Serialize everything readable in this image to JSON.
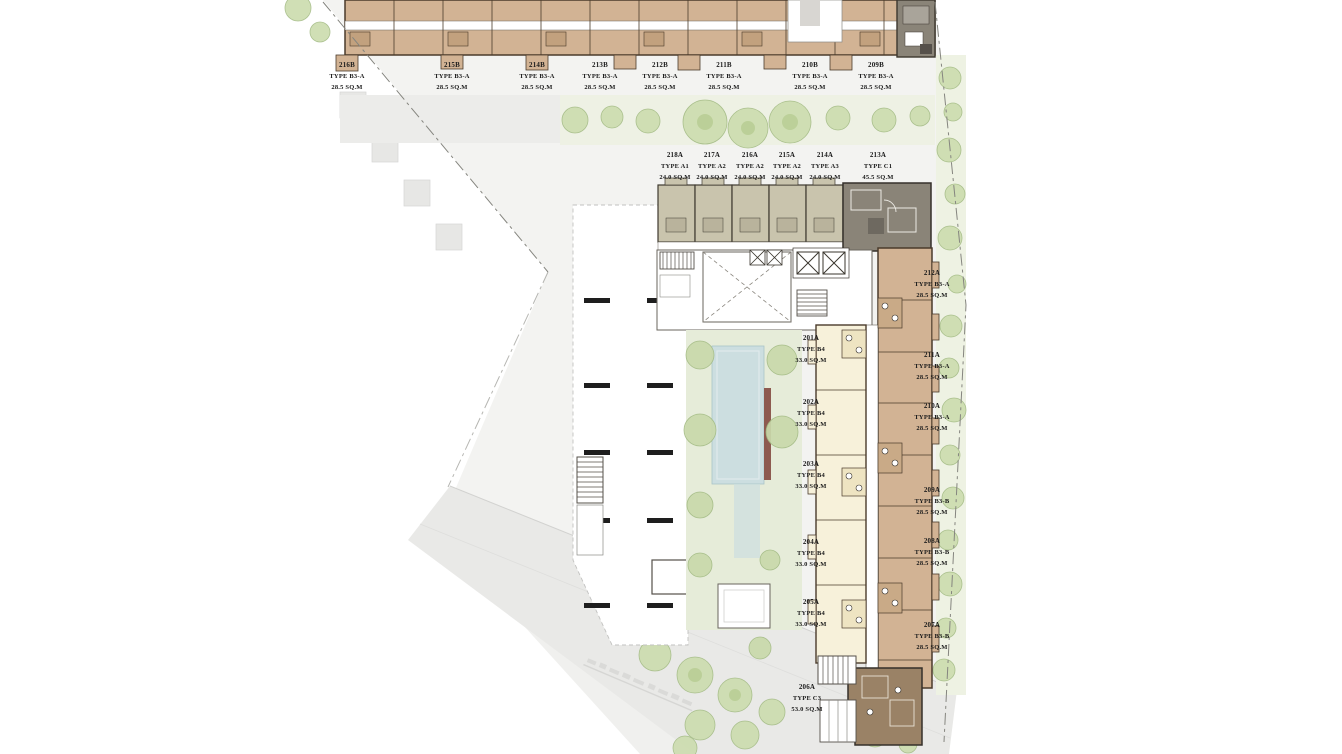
{
  "plan": {
    "name": "residential-floor-plan",
    "palette": {
      "unit_tan": "#d2b394",
      "unit_tan_dark": "#c2a17e",
      "unit_gray": "#8a8478",
      "unit_cream": "#f7f1da",
      "unit_brown": "#9a8266",
      "unit_sage": "#c9c4ad",
      "pool_blue": "#ccdee0",
      "deck_red": "#8d5a50",
      "tree_green": "#ccdcae",
      "parcel_gray": "#f3f3f1",
      "outline_brown": "#4a3b2b"
    }
  },
  "units": {
    "top_row": [
      {
        "id": "216B",
        "type": "TYPE B3-A",
        "area": "28.5 SQ.M"
      },
      {
        "id": "215B",
        "type": "TYPE B3-A",
        "area": "28.5 SQ.M"
      },
      {
        "id": "214B",
        "type": "TYPE B3-A",
        "area": "28.5 SQ.M"
      },
      {
        "id": "213B",
        "type": "TYPE B3-A",
        "area": "28.5 SQ.M"
      },
      {
        "id": "212B",
        "type": "TYPE B3-A",
        "area": "28.5 SQ.M"
      },
      {
        "id": "211B",
        "type": "TYPE B3-A",
        "area": "28.5 SQ.M"
      },
      {
        "id": "210B",
        "type": "TYPE B3-A",
        "area": "28.5 SQ.M"
      },
      {
        "id": "209B",
        "type": "TYPE B3-A",
        "area": "28.5 SQ.M"
      }
    ],
    "a_row": [
      {
        "id": "218A",
        "type": "TYPE A1",
        "area": "24.0 SQ.M"
      },
      {
        "id": "217A",
        "type": "TYPE A2",
        "area": "24.0 SQ.M"
      },
      {
        "id": "216A",
        "type": "TYPE A2",
        "area": "24.0 SQ.M"
      },
      {
        "id": "215A",
        "type": "TYPE A2",
        "area": "24.0 SQ.M"
      },
      {
        "id": "214A",
        "type": "TYPE A3",
        "area": "24.0 SQ.M"
      },
      {
        "id": "213A",
        "type": "TYPE C1",
        "area": "45.5 SQ.M"
      }
    ],
    "right_col": [
      {
        "id": "212A",
        "type": "TYPE B3-A",
        "area": "28.5 SQ.M"
      },
      {
        "id": "211A",
        "type": "TYPE B3-A",
        "area": "28.5 SQ.M"
      },
      {
        "id": "210A",
        "type": "TYPE B3-A",
        "area": "28.5 SQ.M"
      },
      {
        "id": "209A",
        "type": "TYPE B3-B",
        "area": "28.5 SQ.M"
      },
      {
        "id": "208A",
        "type": "TYPE B3-B",
        "area": "28.5 SQ.M"
      },
      {
        "id": "207A",
        "type": "TYPE B3-B",
        "area": "28.5 SQ.M"
      }
    ],
    "left_col": [
      {
        "id": "201A",
        "type": "TYPE B4",
        "area": "33.0 SQ.M"
      },
      {
        "id": "202A",
        "type": "TYPE B4",
        "area": "33.0 SQ.M"
      },
      {
        "id": "203A",
        "type": "TYPE B4",
        "area": "33.0 SQ.M"
      },
      {
        "id": "204A",
        "type": "TYPE B4",
        "area": "33.0 SQ.M"
      },
      {
        "id": "205A",
        "type": "TYPE B4",
        "area": "33.0 SQ.M"
      },
      {
        "id": "206A",
        "type": "TYPE C3",
        "area": "53.0 SQ.M"
      }
    ]
  }
}
